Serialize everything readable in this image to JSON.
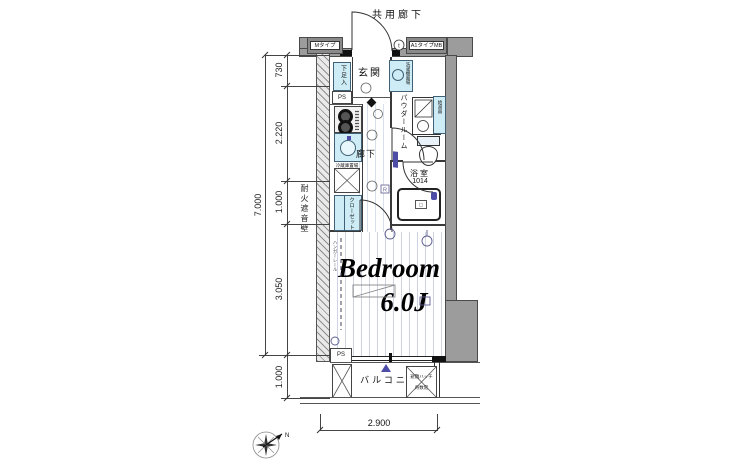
{
  "plan": {
    "corridor_label": "共用廊下",
    "entrance_label": "玄関",
    "hallway_label": "廊下",
    "powder_room_label": "パウダールーム",
    "bathroom_label": "浴室",
    "bathroom_size": "1014",
    "bedroom_name": "Bedroom",
    "bedroom_size": "6.0J",
    "balcony_label": "バルコニー"
  },
  "fixtures": {
    "meter_box_left": "MタイプMB",
    "meter_box_right": "A1タイプMB",
    "shoe_cabinet": "下足入",
    "pipe_space_top": "PS",
    "pipe_space_bottom": "PS",
    "refrigerator_space": "冷蔵庫置場",
    "closet": "クローゼット",
    "washing_machine": "洗濯機置場",
    "water_heater": "給湯器",
    "hanger_rail": "ハンガーレール",
    "fireproof_wall": "耐火遮音壁",
    "evacuation_hatch": "避難ハッチ",
    "evacuation_hatch_note": "奇数階",
    "door_mark": "t"
  },
  "dimensions": {
    "overall_height": "7.000",
    "seg_730": "730",
    "seg_2220": "2.220",
    "seg_1000": "1.000",
    "seg_3050": "3.050",
    "balcony_depth": "1.000",
    "width": "2.900"
  },
  "compass": {
    "north": "N"
  },
  "colors": {
    "wall_gray": "#9c9c9c",
    "fixture_fill": "#cdecf6",
    "accent_purple": "#4d4da8",
    "floor_stripe": "#ccd4e4"
  }
}
